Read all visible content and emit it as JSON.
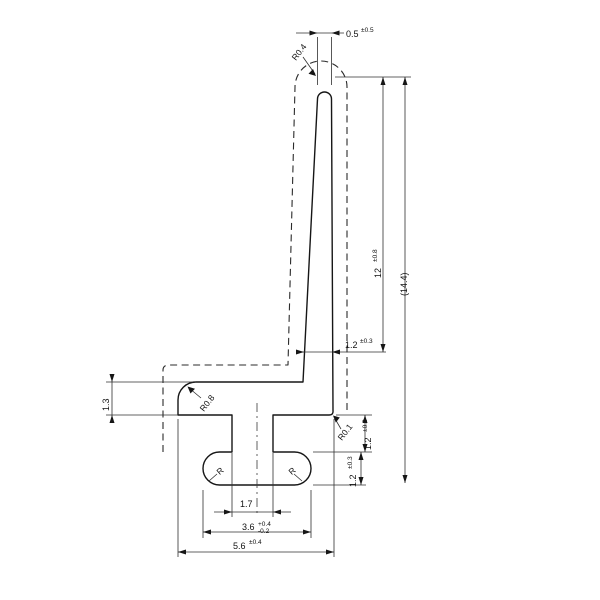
{
  "drawing": {
    "dims": {
      "tip_width": {
        "value": "0.5",
        "tol": "±0.5"
      },
      "blade_height": {
        "value": "12",
        "tol": "±0.8"
      },
      "overall_height": {
        "value": "(14.4)"
      },
      "blade_root_thickness": {
        "value": "1.2",
        "tol": "±0.3"
      },
      "stem_height": {
        "value": "1.2",
        "tol": "±0.3"
      },
      "bulb_thickness": {
        "value": "1.2",
        "tol": "±0.3"
      },
      "lip_thickness": {
        "value": "1.3"
      },
      "slot_width": {
        "value": "1.7"
      },
      "bulb_width": {
        "value": "3.6",
        "tol_plus": "+0.4",
        "tol_minus": "-0.2"
      },
      "overall_width": {
        "value": "5.6",
        "tol": "±0.4"
      }
    },
    "radii": {
      "tip": "R0.4",
      "root": "R0.1",
      "lip": "R0.8",
      "bulb_left": "R",
      "bulb_right": "R"
    }
  }
}
